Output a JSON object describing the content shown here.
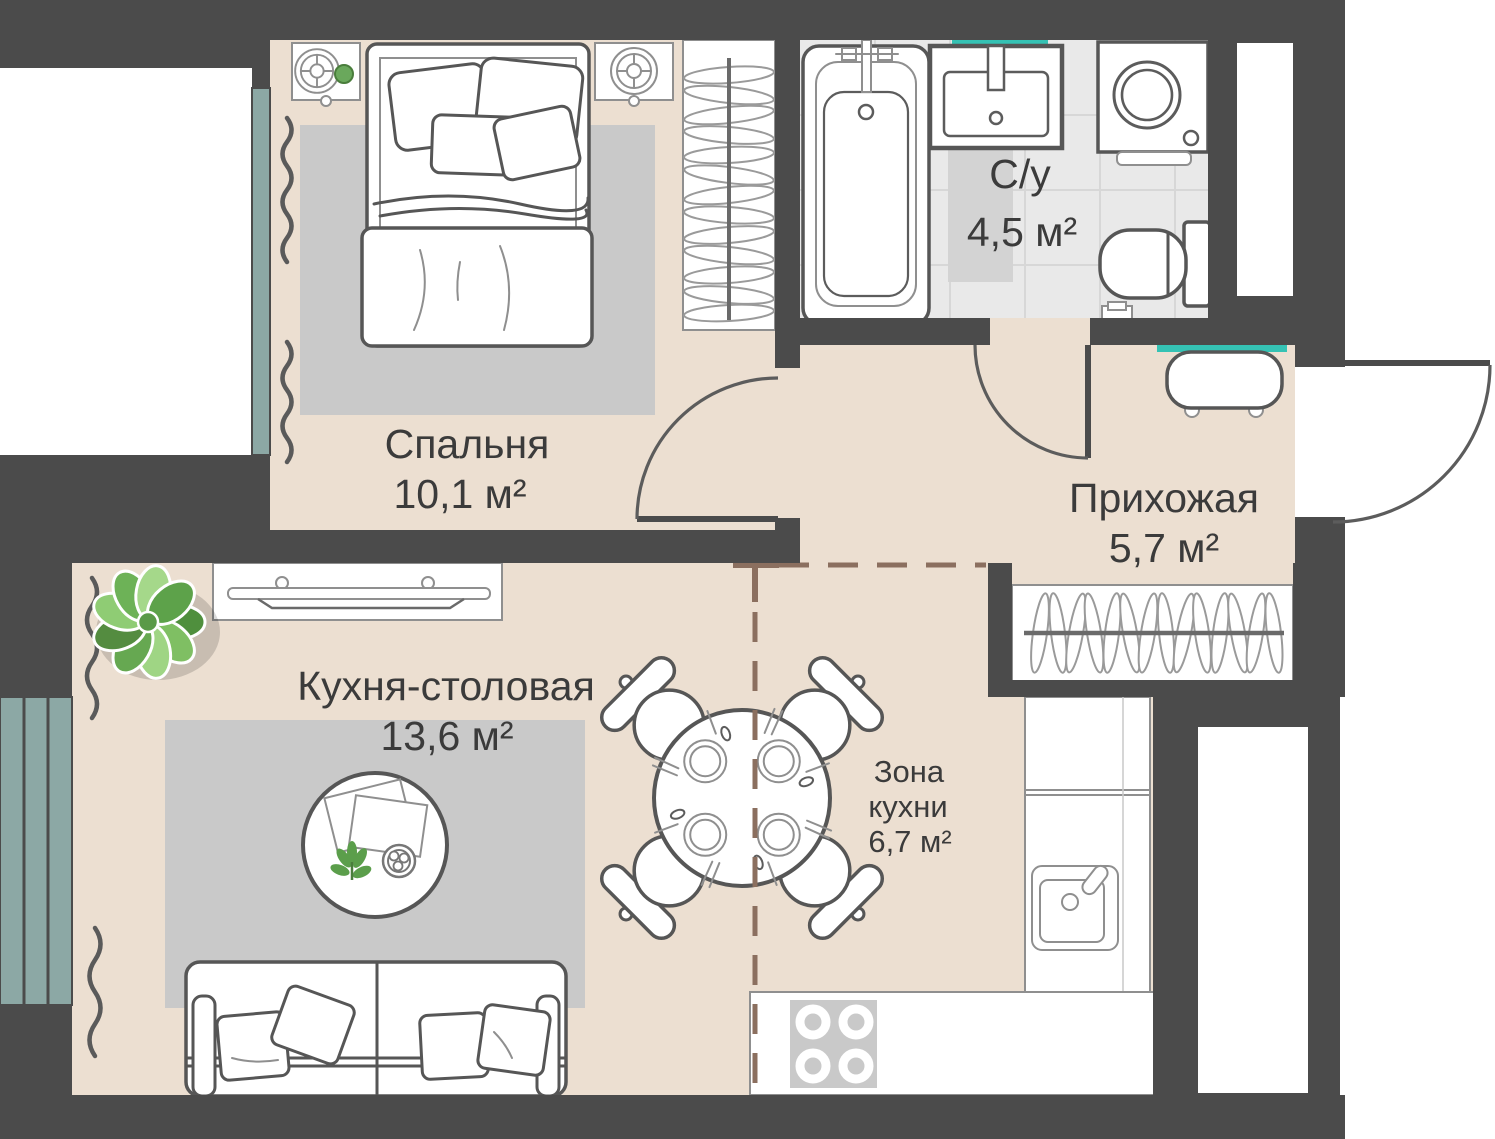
{
  "rooms": {
    "bedroom": {
      "name": "Спальня",
      "area": "10,1 м²"
    },
    "bathroom": {
      "name": "С/у",
      "area": "4,5 м²"
    },
    "hallway": {
      "name": "Прихожая",
      "area": "5,7 м²"
    },
    "kitchen_dining": {
      "name": "Кухня-столовая",
      "area": "13,6 м²"
    },
    "kitchen_zone": {
      "line1": "Зона",
      "line2": "кухни",
      "area": "6,7 м²"
    }
  },
  "colors": {
    "wall": "#4b4b4b",
    "floor": "#ecdfd1",
    "bath": "#e9e9e9",
    "rug": "#c9c9c9",
    "win": "#8ca8a5",
    "teal": "#35c2b4",
    "dash": "#8b6f5f",
    "text": "#3b3b3b"
  }
}
